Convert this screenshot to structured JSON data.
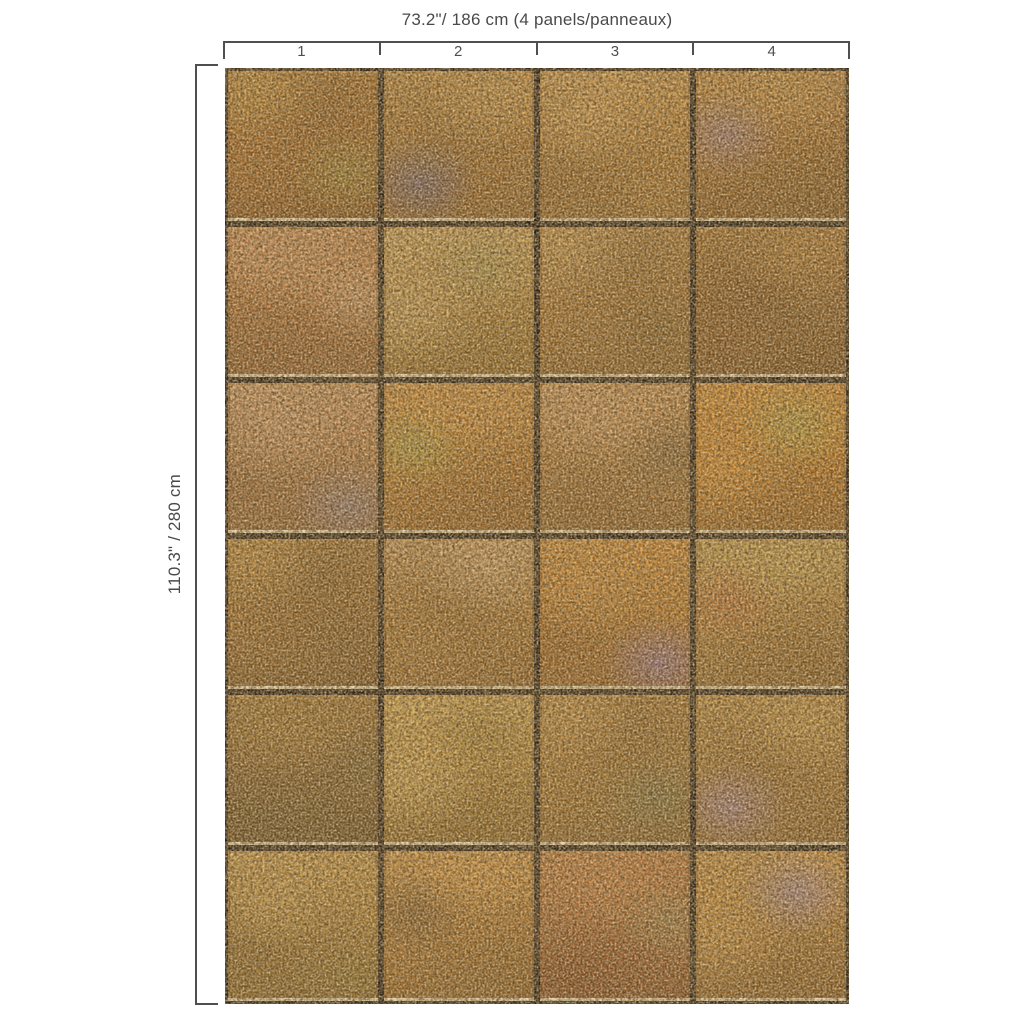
{
  "page": {
    "background": "#ffffff",
    "line_color": "#4f4f4f",
    "text_color": "#4a4a4a"
  },
  "top_ruler": {
    "label": "73.2\"/ 186 cm  (4 panels/panneaux)",
    "panel_numbers": [
      "1",
      "2",
      "3",
      "4"
    ]
  },
  "left_ruler": {
    "label": "110.3\" / 280 cm"
  },
  "wall": {
    "columns": 4,
    "rows": 6,
    "grout_color": "#150e07",
    "edge_highlight": "#f6e8c4",
    "tiles": [
      {
        "colors": {
          "base": "#b46a1e",
          "light": "#c98e33",
          "accent": "#97852e",
          "dark": "#7d4a15"
        }
      },
      {
        "colors": {
          "base": "#b87526",
          "light": "#cf9a47",
          "accent": "#5a5583",
          "dark": "#8a5a1e"
        }
      },
      {
        "colors": {
          "base": "#bc7e2a",
          "light": "#d49e4d",
          "accent": "#b0762a",
          "dark": "#8c5c1e"
        }
      },
      {
        "colors": {
          "base": "#af6c22",
          "light": "#c68c3c",
          "accent": "#9b7f93",
          "dark": "#7e5018"
        }
      },
      {
        "colors": {
          "base": "#bb7130",
          "light": "#d4935c",
          "accent": "#dca87c",
          "dark": "#8c5424"
        }
      },
      {
        "colors": {
          "base": "#bf8c38",
          "light": "#d4ab5f",
          "accent": "#a89a4e",
          "dark": "#90661f"
        }
      },
      {
        "colors": {
          "base": "#b3772b",
          "light": "#cc9a4b",
          "accent": "#7c5a22",
          "dark": "#82561c"
        }
      },
      {
        "colors": {
          "base": "#9c6020",
          "light": "#b67d30",
          "accent": "#875019",
          "dark": "#6e4514"
        }
      },
      {
        "colors": {
          "base": "#bd7f47",
          "light": "#d69d6a",
          "accent": "#8f7e91",
          "dark": "#8d5b2c"
        }
      },
      {
        "colors": {
          "base": "#c47b21",
          "light": "#d69139",
          "accent": "#a8a140",
          "dark": "#93591a"
        }
      },
      {
        "colors": {
          "base": "#b97c33",
          "light": "#d1985c",
          "accent": "#6f5630",
          "dark": "#8a5a22"
        }
      },
      {
        "colors": {
          "base": "#cb7c19",
          "light": "#e0902a",
          "accent": "#b2a83e",
          "dark": "#9a5c14"
        }
      },
      {
        "colors": {
          "base": "#a76a22",
          "light": "#c08a38",
          "accent": "#7c551f",
          "dark": "#6f4a18"
        }
      },
      {
        "colors": {
          "base": "#bc7e2c",
          "light": "#d8a96c",
          "accent": "#a87028",
          "dark": "#8a5a1e"
        }
      },
      {
        "colors": {
          "base": "#c47a20",
          "light": "#d78e32",
          "accent": "#9070ae",
          "dark": "#92581a"
        }
      },
      {
        "colors": {
          "base": "#b98532",
          "light": "#c9a24a",
          "accent": "#c2662a",
          "dark": "#8a5c1e"
        }
      },
      {
        "colors": {
          "base": "#8c5e22",
          "light": "#a3752c",
          "accent": "#6d5526",
          "dark": "#5f451a"
        }
      },
      {
        "colors": {
          "base": "#c19034",
          "light": "#d6ab51",
          "accent": "#9c7828",
          "dark": "#8a621f"
        }
      },
      {
        "colors": {
          "base": "#b27b28",
          "light": "#cc9440",
          "accent": "#74703f",
          "dark": "#7e5620"
        }
      },
      {
        "colors": {
          "base": "#b5802e",
          "light": "#cb9a44",
          "accent": "#a886a8",
          "dark": "#86581f"
        }
      },
      {
        "colors": {
          "base": "#b8862f",
          "light": "#cfa04a",
          "accent": "#8f742a",
          "dark": "#7e5a1e"
        }
      },
      {
        "colors": {
          "base": "#c07c28",
          "light": "#d6963f",
          "accent": "#6b4a1e",
          "dark": "#8c5a1c"
        }
      },
      {
        "colors": {
          "base": "#b4632a",
          "light": "#c97e3c",
          "accent": "#998549",
          "dark": "#7e4218"
        }
      },
      {
        "colors": {
          "base": "#bb7d2a",
          "light": "#d0953f",
          "accent": "#a78cb4",
          "dark": "#8a5a1e"
        }
      }
    ]
  }
}
